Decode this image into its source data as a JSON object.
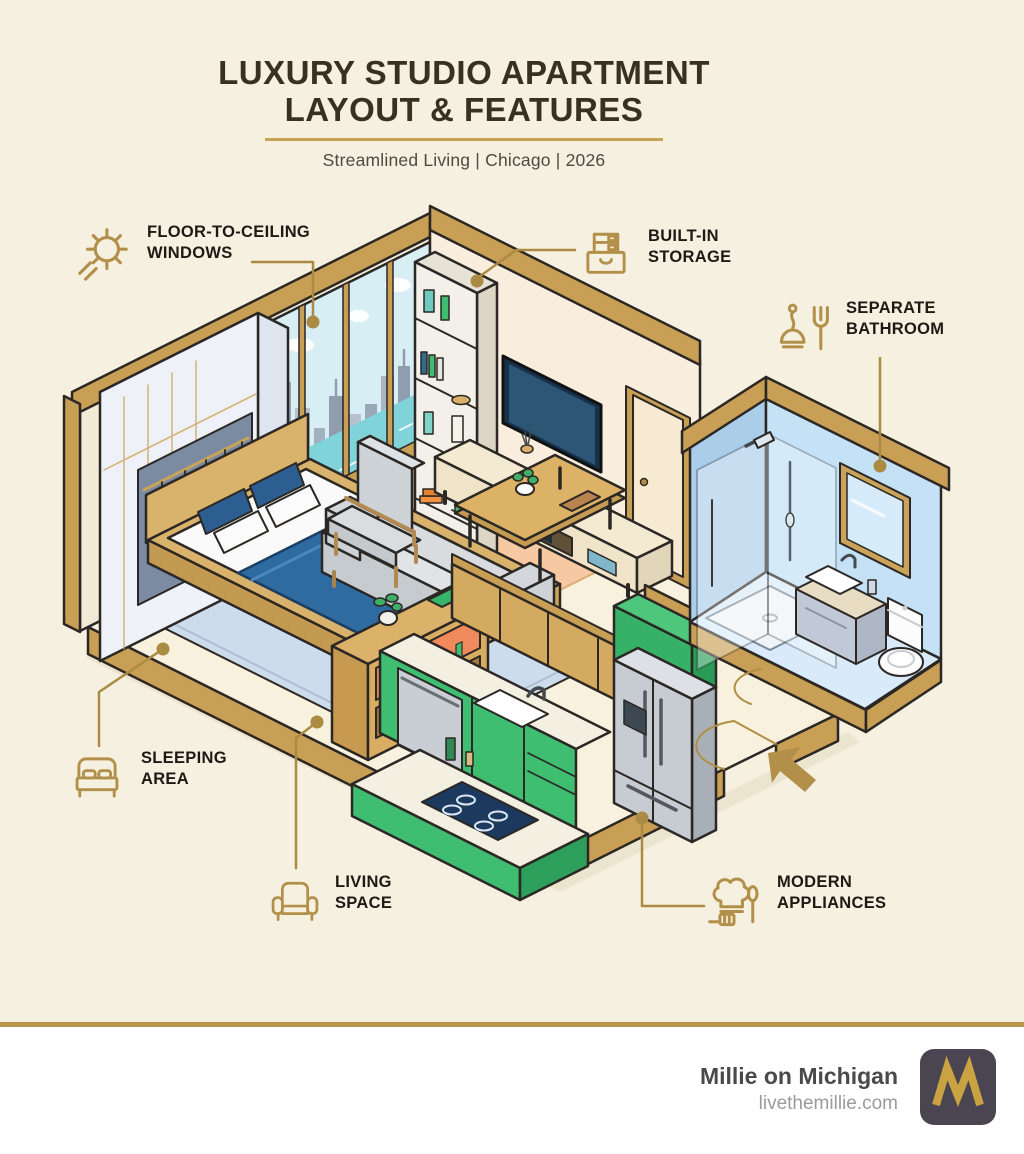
{
  "header": {
    "title_line1": "LUXURY STUDIO APARTMENT",
    "title_line2": "LAYOUT & FEATURES",
    "subtitle": "Streamlined Living | Chicago | 2026"
  },
  "features": [
    {
      "id": "windows",
      "icon": "sun-icon",
      "line1": "FLOOR-TO-CEILING",
      "line2": "WINDOWS"
    },
    {
      "id": "storage",
      "icon": "storage-drawer-icon",
      "line1": "BUILT-IN",
      "line2": "STORAGE"
    },
    {
      "id": "bathroom",
      "icon": "plunger-fork-icon",
      "line1": "SEPARATE",
      "line2": "BATHROOM"
    },
    {
      "id": "sleeping",
      "icon": "bed-icon",
      "line1": "SLEEPING",
      "line2": "AREA"
    },
    {
      "id": "living",
      "icon": "armchair-icon",
      "line1": "LIVING",
      "line2": "SPACE"
    },
    {
      "id": "appliances",
      "icon": "chef-hat-icon",
      "line1": "MODERN",
      "line2": "APPLIANCES"
    }
  ],
  "footer": {
    "brand": "Millie on Michigan",
    "website": "livethemillie.com",
    "logo_letter": "M"
  },
  "colors": {
    "background": "#f6f0e0",
    "accent_gold": "#b2904a",
    "trim_gold": "#c89f55",
    "title_brown": "#3a2f23",
    "label_text": "#1e1914",
    "kitchen_green": "#3fbe71",
    "bathroom_blue": "#c4e1f6",
    "bed_blue": "#2e6ba0",
    "rug_peach": "#f6c9a2",
    "water_teal": "#7fd3d9",
    "divider_gold": "#b9964a",
    "logo_bg": "#4a4550",
    "logo_gold": "#c9a241"
  }
}
